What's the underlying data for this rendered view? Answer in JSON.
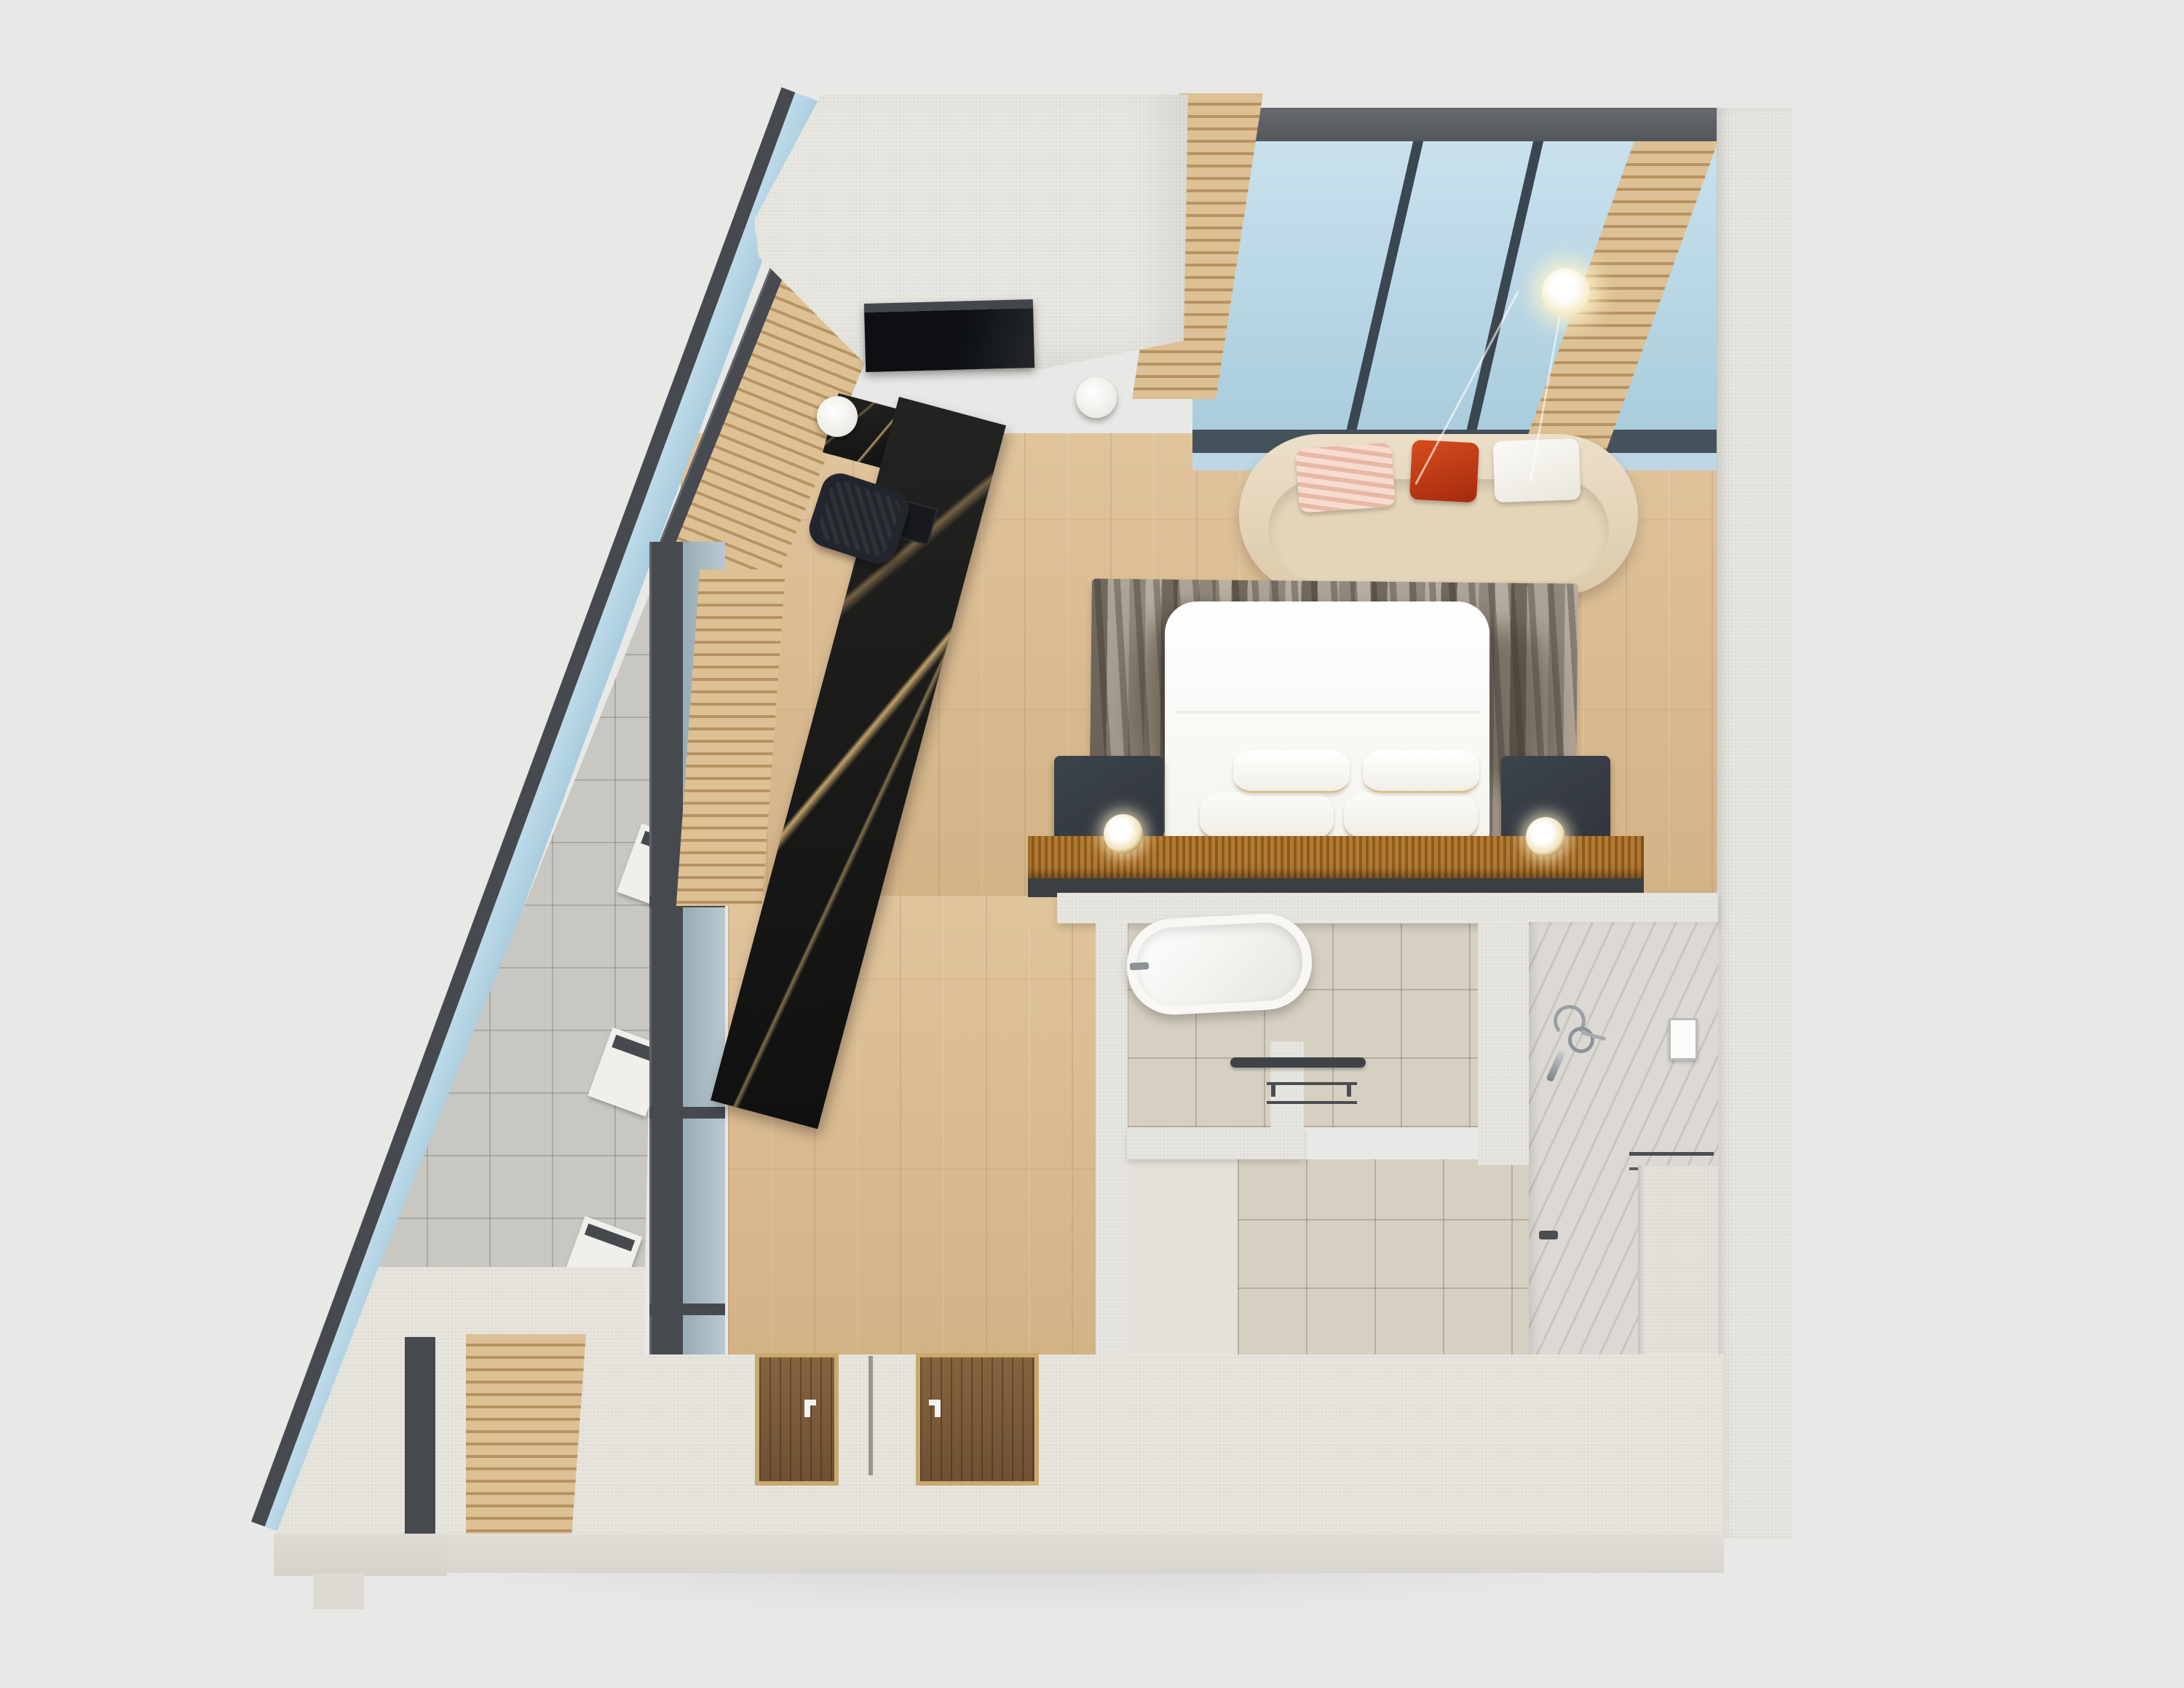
{
  "scene": {
    "kind": "3d-floor-plan-render",
    "view": "top-down axonometric",
    "description": "Rendered top-view plan of a studio hotel suite with angled glazed facade, skylight lounge, bedroom and en-suite bathroom"
  },
  "palette": {
    "background": "#e8e9e7",
    "wall_cream": "#e9e7e1",
    "frame_dark_gray": "#46494e",
    "glass_blue": "#b4d6e4",
    "wood_floor": "#dabb8f",
    "wood_slats": "#d8bc90",
    "door_wood_dark": "#7b5a3a",
    "marble_desk_black": "#161614",
    "marble_vanity_white": "#f3f2ef",
    "sofa_cream": "#e7dcc4",
    "rug_taupe": "#b1a899",
    "bed_white": "#fcfcfa",
    "nightstand_charcoal": "#373d44",
    "headboard_amber": "#a8732e",
    "tile_beige": "#d6d0c3",
    "tile_balcony_gray": "#c9c7c1",
    "stone_shower_gray": "#dcd9d4"
  },
  "labels": {
    "plan": "Hotel suite floor plan render",
    "skylight": "Sloped skylight glazing with dark mullions",
    "slat_screen": "Timber slat accent screen",
    "facade": "Angled glazed facade with dark frame",
    "balcony": "Triangular balcony with gray tile floor and planters",
    "planter": "White planter box",
    "tv_volume": "Wardrobe volume with wall-mounted TV",
    "tv": "Wall-mounted television",
    "sofa": "Curved cream sofa with cushions",
    "cushion_striped": "Blush striped cushion",
    "cushion_red": "Red-orange cushion",
    "cushion_white": "White cushion",
    "side_table": "Round white side table",
    "pendant_lamp": "Glowing pendant lamp",
    "desk": "Black marble writing desk",
    "desk_lamp": "White cylinder table lamp",
    "laptop": "Laptop on desk",
    "chair": "Upholstered desk chair",
    "rug": "Abstract taupe and charcoal rug",
    "bed": "Double bed with white duvet and pillows",
    "pillow": "White pillow with gold trim",
    "nightstand": "Charcoal nightstand",
    "headboard": "Amber woven headboard console",
    "table_lamp": "Brass and white bedside lamp",
    "bathroom": "En-suite bathroom",
    "bathtub": "Freestanding white oval bathtub",
    "towel_bar": "Dark towel bar",
    "shower_mixer": "Chrome shower mixer",
    "soap_dispenser": "Wall soap dispenser",
    "vanity": "Marble vanity with inset niche and basin",
    "niche": "Recessed marble niche shelf",
    "mirror": "Framed vanity mirror",
    "bench": "Stone bench ledge",
    "door": "Timber entry door with white handle",
    "wood_floor": "Oak plank flooring",
    "corridor": "Wardrobe corridor",
    "right_wall": "Cream textured party wall"
  }
}
